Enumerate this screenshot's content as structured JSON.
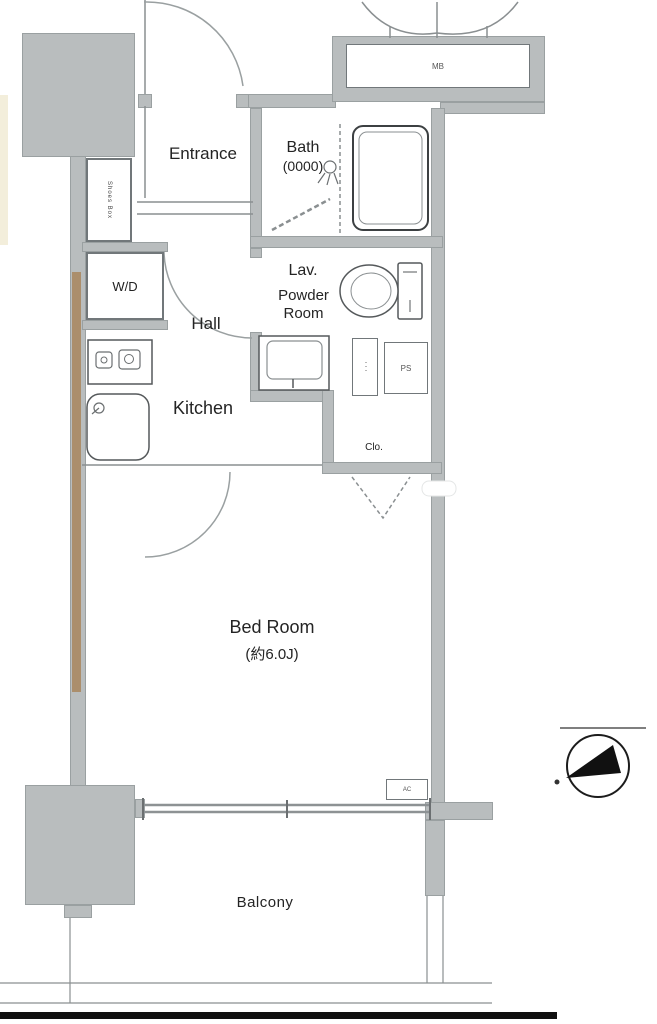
{
  "plan": {
    "title": "apartment-floor-plan",
    "rooms": {
      "entrance": "Entrance",
      "bath": "Bath",
      "bath_size": "(0000)",
      "washer_dryer": "W/D",
      "lavatory": "Lav.",
      "powder_room_line1": "Powder",
      "powder_room_line2": "Room",
      "hall": "Hall",
      "kitchen": "Kitchen",
      "bedroom": "Bed Room",
      "bedroom_size": "(約6.0J)",
      "closet": "Clo.",
      "balcony": "Balcony"
    },
    "fixtures": {
      "meter_box": "MB",
      "pipe_space": "PS",
      "shoes_box": "Shoes Box",
      "storage_strip": "･･･",
      "air_conditioner": "AC"
    },
    "colors": {
      "wall_fill": "#b9bdbe",
      "wall_edge": "#9aa0a1",
      "tan_wall": "#ab8e6c",
      "cream_strip": "#f3eedb",
      "line": "#8a8f91",
      "text": "#242424",
      "base_line": "#101010"
    }
  }
}
